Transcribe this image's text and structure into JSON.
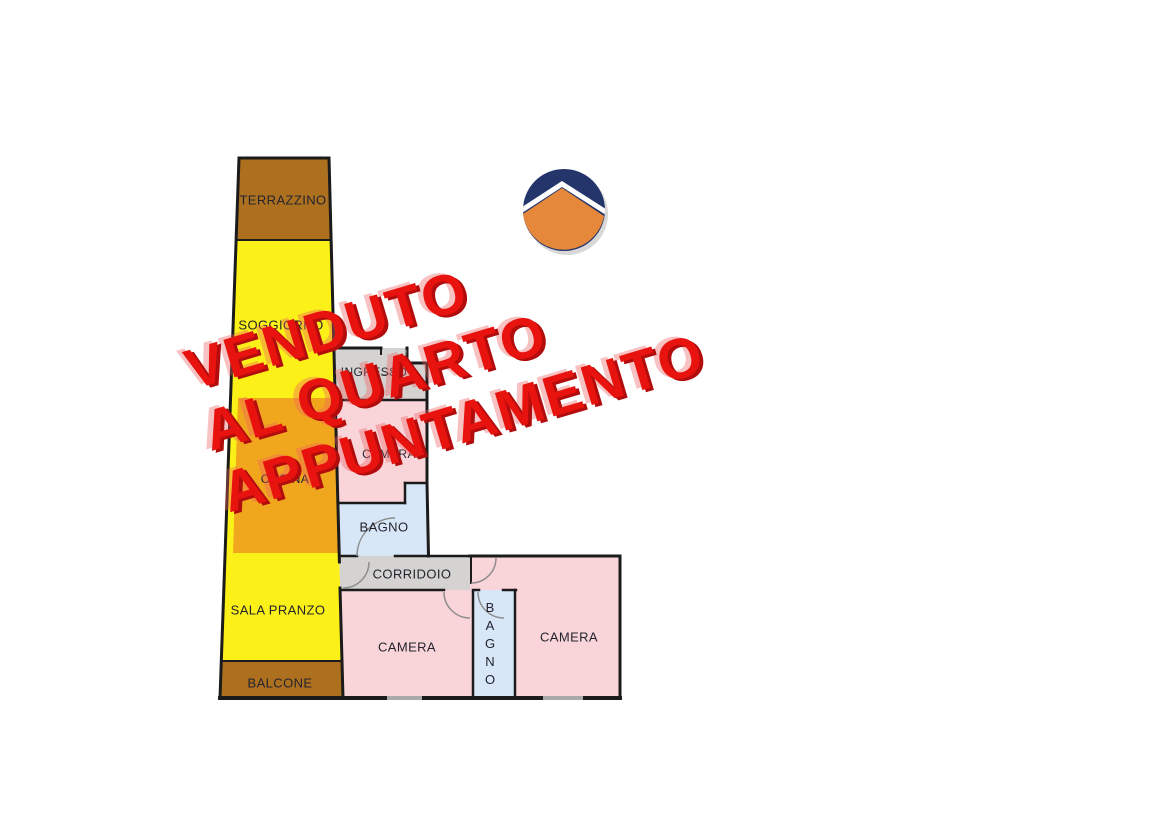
{
  "floorplan": {
    "rooms": [
      {
        "name": "terrazzino",
        "label": "TERRAZZINO",
        "color": "#AD701F"
      },
      {
        "name": "soggiorno",
        "label": "SOGGIORNO",
        "color": "#FBF118"
      },
      {
        "name": "ingresso",
        "label": "INGRESSO",
        "color": "#D4D3D1"
      },
      {
        "name": "cucina",
        "label": "CUCINA",
        "color": "#F0A71E"
      },
      {
        "name": "camera-1",
        "label": "CAMERA",
        "color": "#F9D5DA"
      },
      {
        "name": "bagno-1",
        "label": "BAGNO",
        "color": "#D8E7F7"
      },
      {
        "name": "corridoio",
        "label": "CORRIDOIO",
        "color": "#D4D3D1"
      },
      {
        "name": "sala-pranzo",
        "label": "SALA PRANZO",
        "color": "#FBF118"
      },
      {
        "name": "balcone",
        "label": "BALCONE",
        "color": "#AD701F"
      },
      {
        "name": "camera-2",
        "label": "CAMERA",
        "color": "#F9D5DA"
      },
      {
        "name": "bagno-2",
        "label": "BAGNO",
        "color": "#D8E7F7"
      },
      {
        "name": "camera-3",
        "label": "CAMERA",
        "color": "#F9D5DA"
      }
    ],
    "wall_color": "#1b1b1b",
    "window_color": "#a9a9a9",
    "label_color": "#23232e"
  },
  "watermark": {
    "lines": [
      "VENDUTO",
      "AL QUARTO",
      "APPUNTAMENTO"
    ],
    "color": "#E8130F"
  },
  "logo": {
    "navy": "#24356B",
    "orange": "#E6883B"
  }
}
